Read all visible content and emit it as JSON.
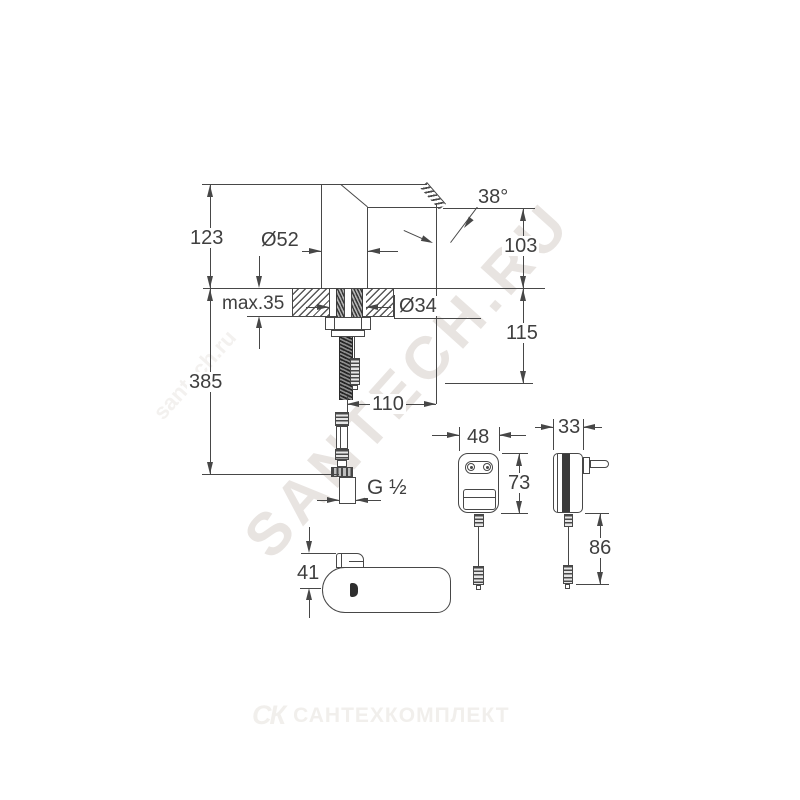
{
  "dims": {
    "height_above_deck": "123",
    "total_height": "385",
    "deck_thickness": "max.35",
    "body_diameter": "Ø52",
    "hole_diameter": "Ø34",
    "spout_angle": "38°",
    "outlet_height": "103",
    "below_deck_depth": "115",
    "spout_reach": "110",
    "thread_size": "G ½",
    "adapter_width": "48",
    "adapter_height": "73",
    "adapter_depth": "33",
    "adapter_cable_length": "86",
    "top_view_depth": "41"
  },
  "watermarks": {
    "diagonal": "SANTECH.RU",
    "diagonal_small": "santech.ru",
    "bottom_logo": "СК",
    "bottom_name": "САНТЕХКОМПЛЕКТ"
  },
  "colors": {
    "line_color": "#474747",
    "watermark_color": "#e8e4e1",
    "watermark_bottom_color": "#f1efec",
    "sensor_mark_color": "#2e2e2e"
  }
}
